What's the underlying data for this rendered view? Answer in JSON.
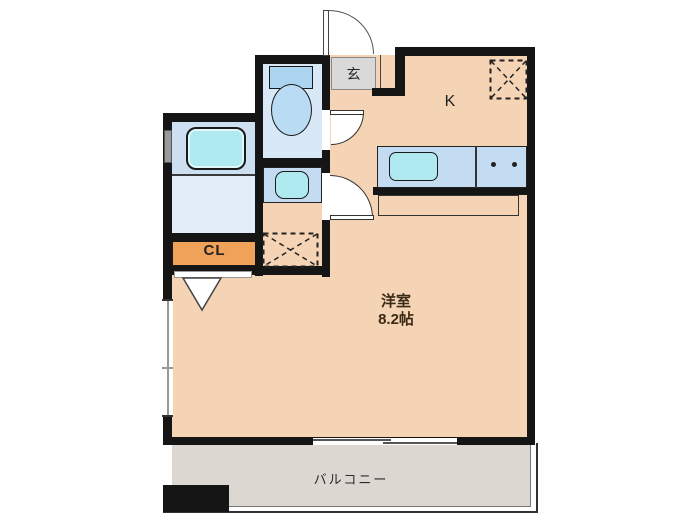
{
  "plan": {
    "labels": {
      "entrance": "玄",
      "kitchen": "K",
      "closet": "CL",
      "main_room_name": "洋室",
      "main_room_size": "8.2帖",
      "balcony": "バルコニー"
    },
    "colors": {
      "wall": "#151515",
      "floor_peach": "#f5d4b5",
      "wet_room_blue": "#d8e8f7",
      "bath_upper_blue": "#cde0f2",
      "bath_lower_blue": "#e3edf9",
      "fixture_cyan": "#aeeaf0",
      "counter_blue": "#c4dcf2",
      "closet_orange": "#efa258",
      "entrance_gray": "#d9d9d9",
      "balcony_gray": "#dcd8d1"
    },
    "fixtures": {
      "bathtub": "bathtub-icon",
      "toilet": "toilet-icon",
      "washbasin": "washbasin-icon",
      "kitchen_sink": "kitchen-sink-icon",
      "stove_burners": "two-burner-stove-icon",
      "refrigerator_space": "refrigerator-space-dashed-box",
      "washing_machine_space": "washing-machine-space-dashed-box"
    }
  }
}
